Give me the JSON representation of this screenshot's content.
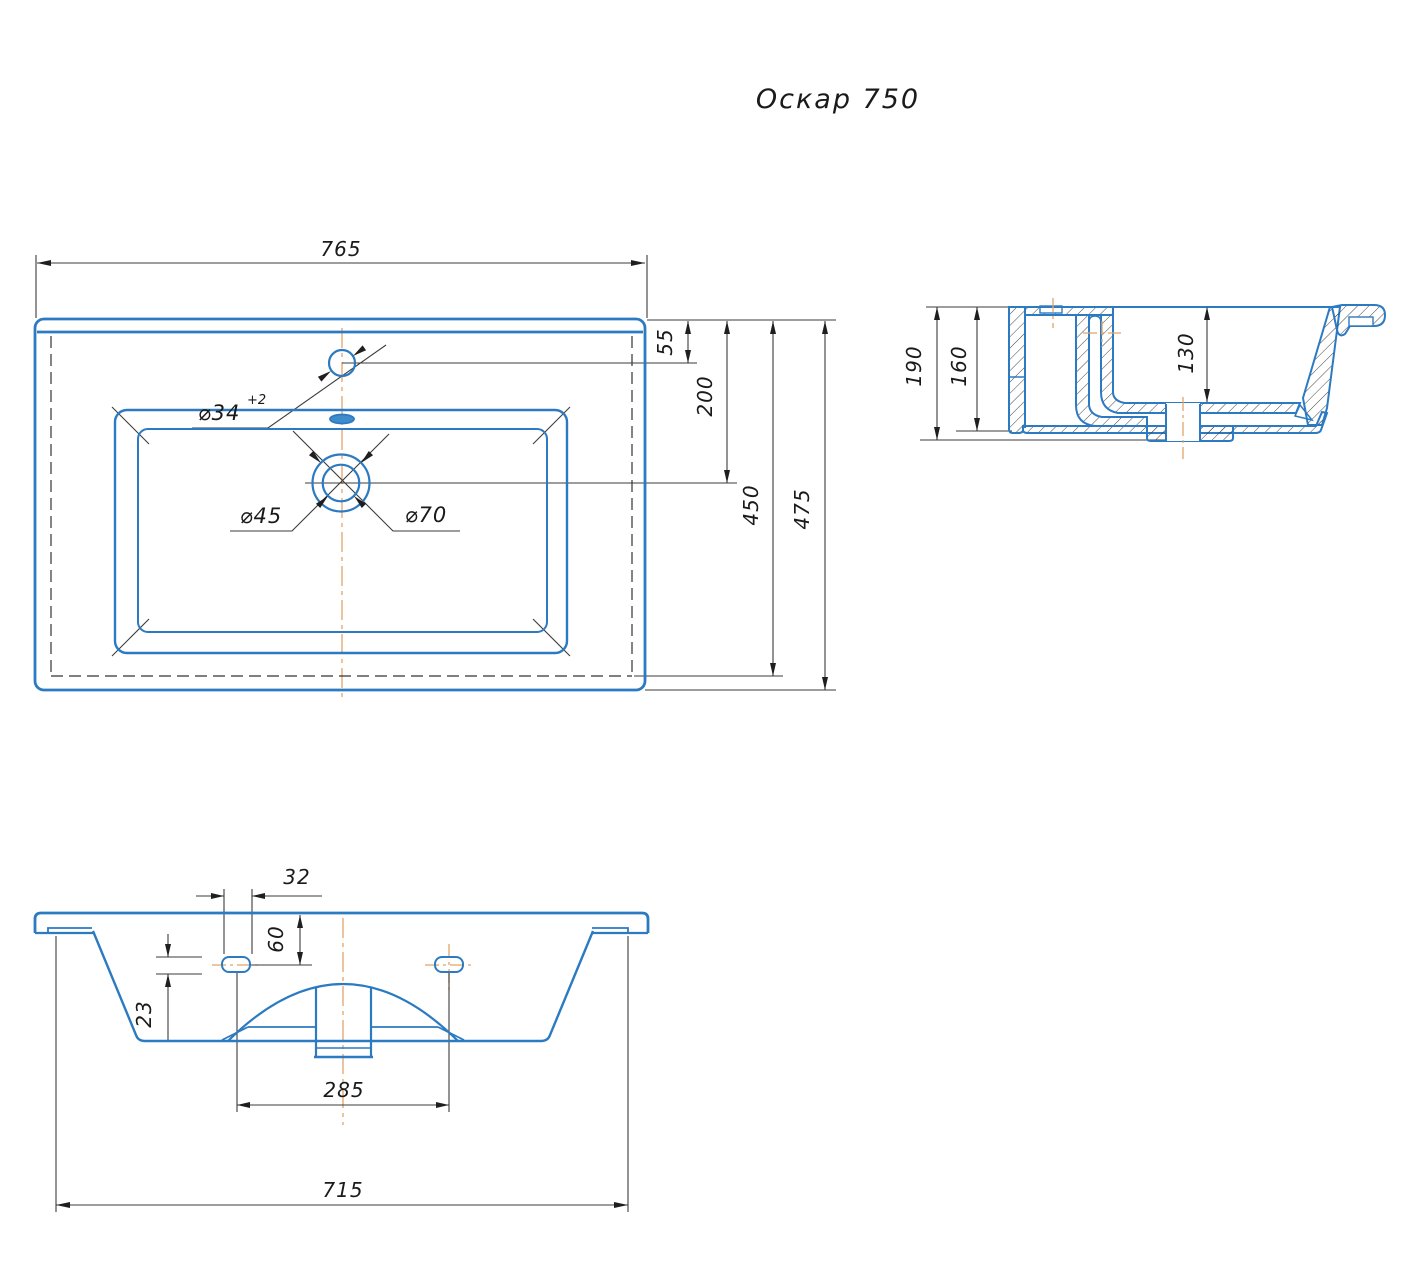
{
  "title": "Оскар 750",
  "colors": {
    "contour_blue": "#2b7ac2",
    "centerline_orange": "#e2a368",
    "dim_line": "#3b3b3b",
    "hatch": "#2f2f2f",
    "text": "#1a1a1a"
  },
  "top_view": {
    "overall_width": "765",
    "edge_to_faucet_center": "55",
    "edge_to_drain_center": "200",
    "inner_depth": "450",
    "overall_depth": "475",
    "faucet_hole_dia": "⌀34",
    "faucet_hole_tolerance": "+2",
    "drain_inner_dia": "⌀45",
    "drain_outer_dia": "⌀70"
  },
  "section_view": {
    "overall_height": "190",
    "body_height": "160",
    "bowl_depth": "130"
  },
  "front_view": {
    "mount_slot_width": "32",
    "top_to_slot_center": "60",
    "mount_slot_height": "23",
    "slot_spacing": "285",
    "mounting_width": "715"
  }
}
